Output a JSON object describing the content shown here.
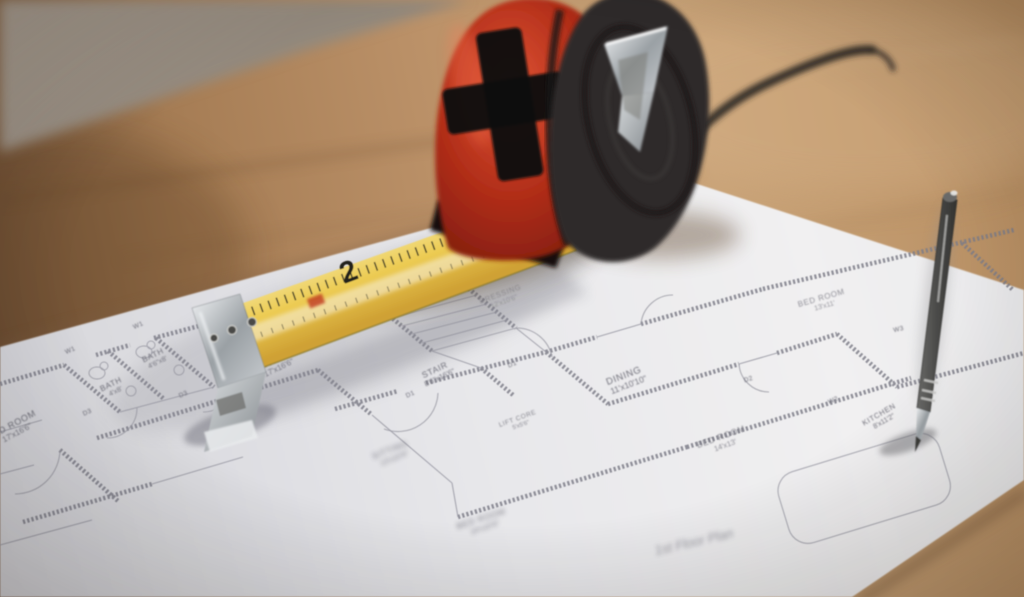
{
  "floor_plan": {
    "title": "1st Floor Plan",
    "rooms": [
      {
        "name": "BATH",
        "dims": "4'x8'"
      },
      {
        "name": "BATH",
        "dims": "4'6\"x8'"
      },
      {
        "name": "BED ROOM",
        "dims": "17'x16'6\""
      },
      {
        "name": "LIVING",
        "dims": "17'x16'6\""
      },
      {
        "name": "STAIR",
        "dims": "8'6\"x16'6\""
      },
      {
        "name": "DRESSING",
        "dims": "12'x10'6\""
      },
      {
        "name": "LIFT CORE",
        "dims": "5'x5'6\""
      },
      {
        "name": "DINING",
        "dims": "11'x10'10\""
      },
      {
        "name": "BED ROOM",
        "dims": "13'x11'"
      },
      {
        "name": "KITCHEN",
        "dims": "8'x11'2\""
      },
      {
        "name": "BED ROOM",
        "dims": "14'x13'"
      },
      {
        "name": "SITTING",
        "dims": "13'x10'6\""
      },
      {
        "name": "BED ROOM",
        "dims": "14'x10'6\""
      }
    ],
    "door_tags": [
      "D3",
      "D3",
      "D1",
      "D1",
      "D2"
    ],
    "window_tags": [
      "W1",
      "W1",
      "W2",
      "W3"
    ]
  },
  "tape_measure": {
    "blade_numbers": [
      "2",
      "3"
    ]
  },
  "colors": {
    "wall": "#9b8f83",
    "wood": "#b68c63",
    "paper": "#e9e9ec",
    "plan_line": "#7e7e88",
    "tape_body_red": "#c13a24",
    "tape_dark_side": "#2d2b2a",
    "blade_yellow": "#ecc94f",
    "pen_gray": "#4a4a48",
    "metal": "#c9cdd1"
  }
}
